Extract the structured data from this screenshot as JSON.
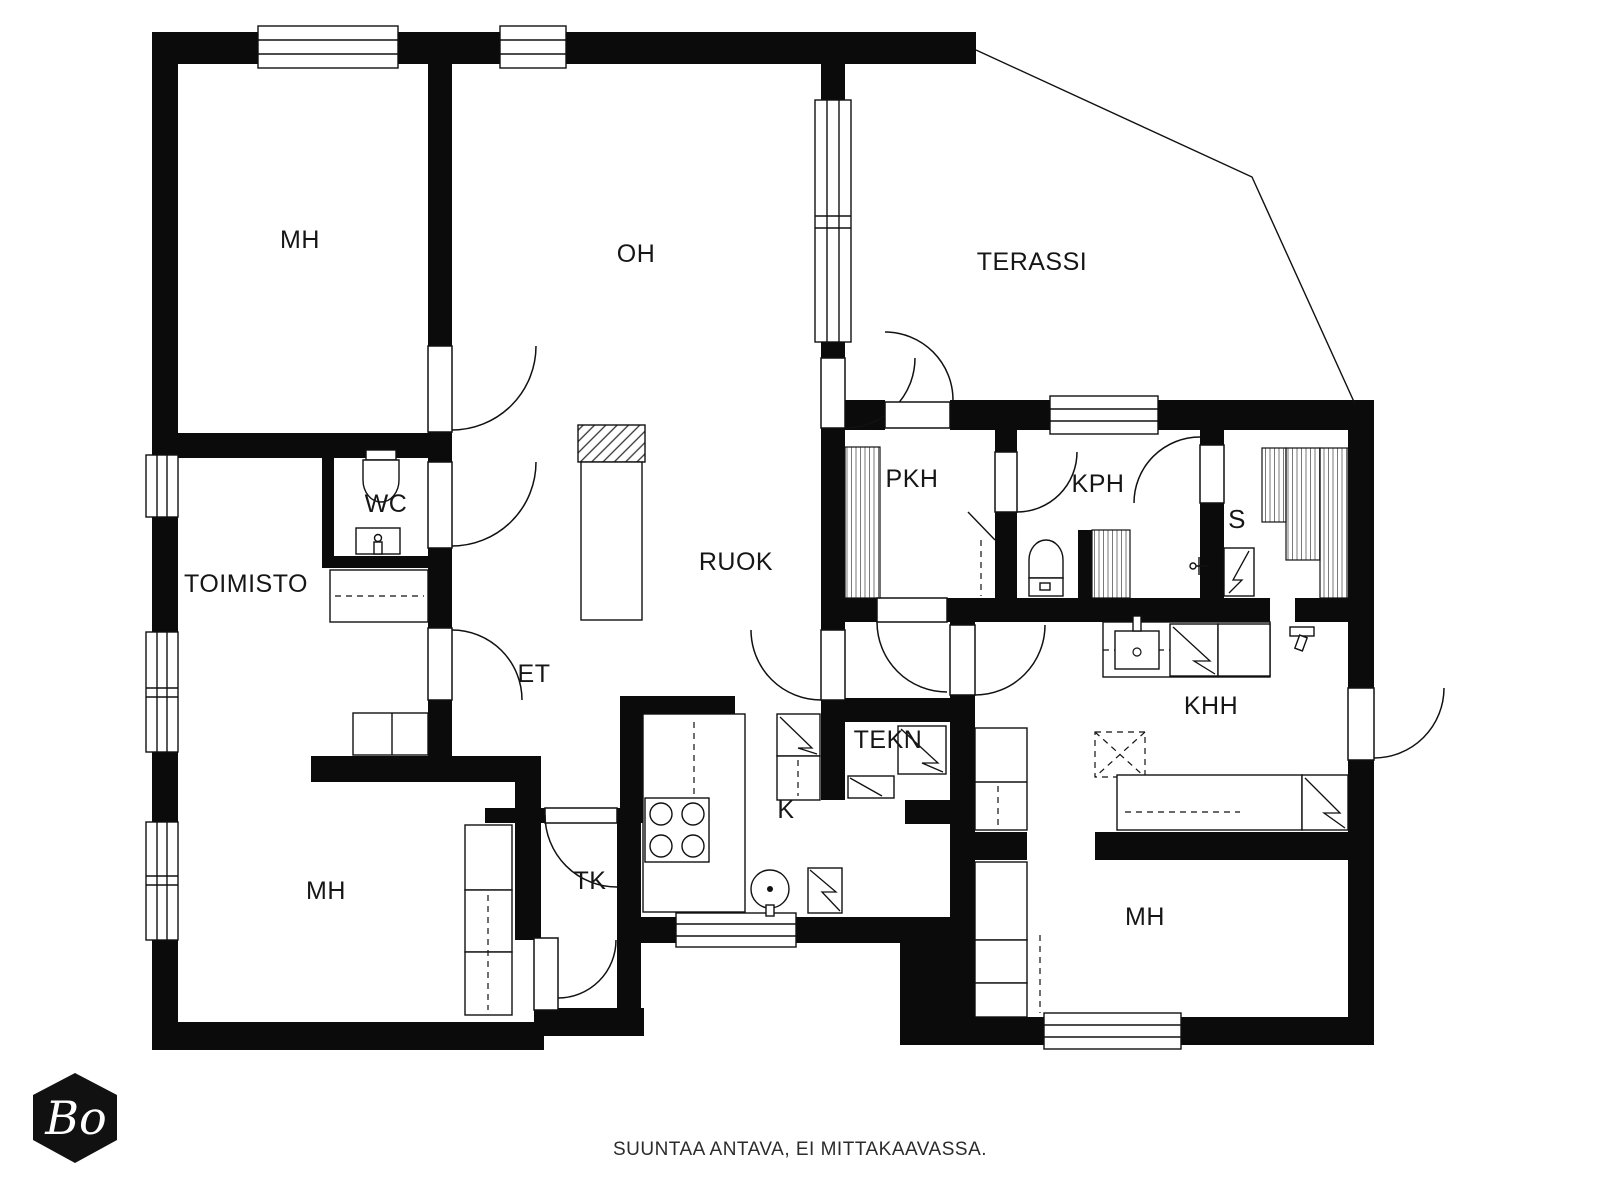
{
  "colors": {
    "walls": "#0b0b0b",
    "background": "#ffffff"
  },
  "rooms": {
    "mh_top_left": {
      "label": "MH"
    },
    "oh": {
      "label": "OH"
    },
    "terassi": {
      "label": "TERASSI"
    },
    "wc": {
      "label": "WC"
    },
    "toimisto": {
      "label": "TOIMISTO"
    },
    "ruok": {
      "label": "RUOK"
    },
    "et": {
      "label": "ET"
    },
    "pkh": {
      "label": "PKH"
    },
    "kph": {
      "label": "KPH"
    },
    "sauna": {
      "label": "S"
    },
    "tekn": {
      "label": "TEKN"
    },
    "keittio": {
      "label": "K"
    },
    "tk": {
      "label": "TK"
    },
    "khh": {
      "label": "KHH"
    },
    "mh_bottom_right": {
      "label": "MH"
    },
    "mh_bottom_left": {
      "label": "MH"
    }
  },
  "logo": {
    "text": "Bo"
  },
  "footer": {
    "disclaimer": "SUUNTAA ANTAVA, EI MITTAKAAVASSA."
  }
}
